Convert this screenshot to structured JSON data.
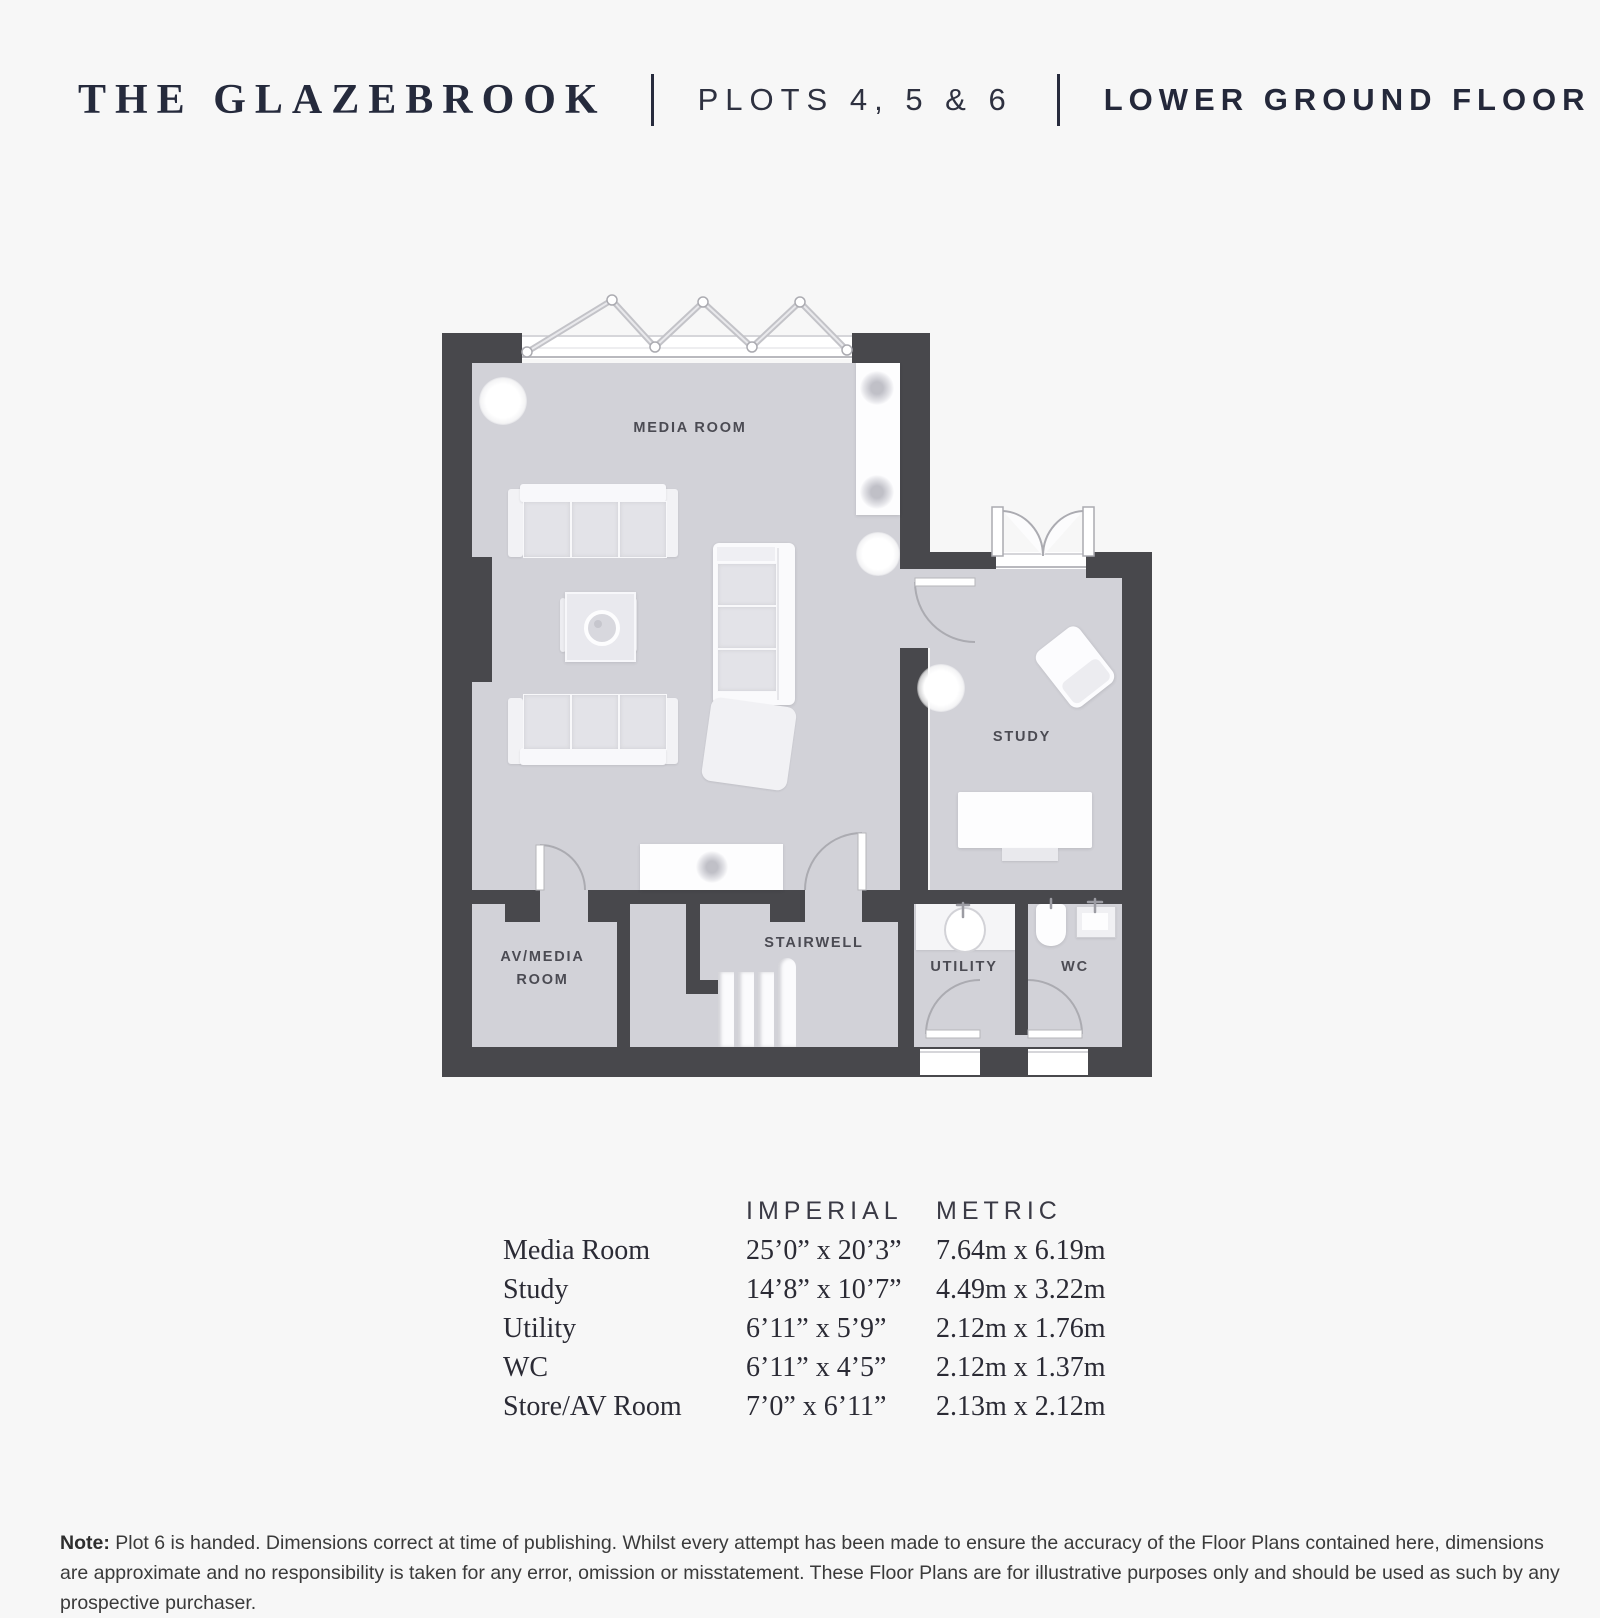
{
  "header": {
    "title": "THE GLAZEBROOK",
    "separator": "|",
    "plots": "PLOTS 4, 5 & 6",
    "floor": "LOWER GROUND FLOOR"
  },
  "plan": {
    "labels": {
      "media_room": "MEDIA ROOM",
      "study": "STUDY",
      "stairwell": "STAIRWELL",
      "av_media_line1": "AV/MEDIA",
      "av_media_line2": "ROOM",
      "utility": "UTILITY",
      "wc": "WC"
    }
  },
  "dimensions": {
    "headers": {
      "imperial": "IMPERIAL",
      "metric": "METRIC"
    },
    "rows": [
      {
        "room": "Media Room",
        "imperial": "25’0” x 20’3”",
        "metric": "7.64m x 6.19m"
      },
      {
        "room": "Study",
        "imperial": "14’8” x 10’7”",
        "metric": "4.49m x 3.22m"
      },
      {
        "room": "Utility",
        "imperial": "6’11” x 5’9”",
        "metric": "2.12m x 1.76m"
      },
      {
        "room": "WC",
        "imperial": "6’11” x  4’5”",
        "metric": "2.12m x 1.37m"
      },
      {
        "room": "Store/AV Room",
        "imperial": "7’0” x  6’11”",
        "metric": "2.13m x 2.12m"
      }
    ]
  },
  "footer": {
    "note_label": "Note:",
    "note_text": " Plot 6 is handed. Dimensions correct at time of publishing. Whilst every attempt has been made to ensure the accuracy of the Floor Plans contained here, dimensions are approximate and no responsibility is taken for any error, omission or misstatement. These Floor Plans are for illustrative purposes only and should be used as such by any prospective purchaser."
  },
  "colors": {
    "wall": "#48484c",
    "floor": "#d2d2d8",
    "background": "#f7f7f7",
    "accent_text": "#252a3c"
  }
}
